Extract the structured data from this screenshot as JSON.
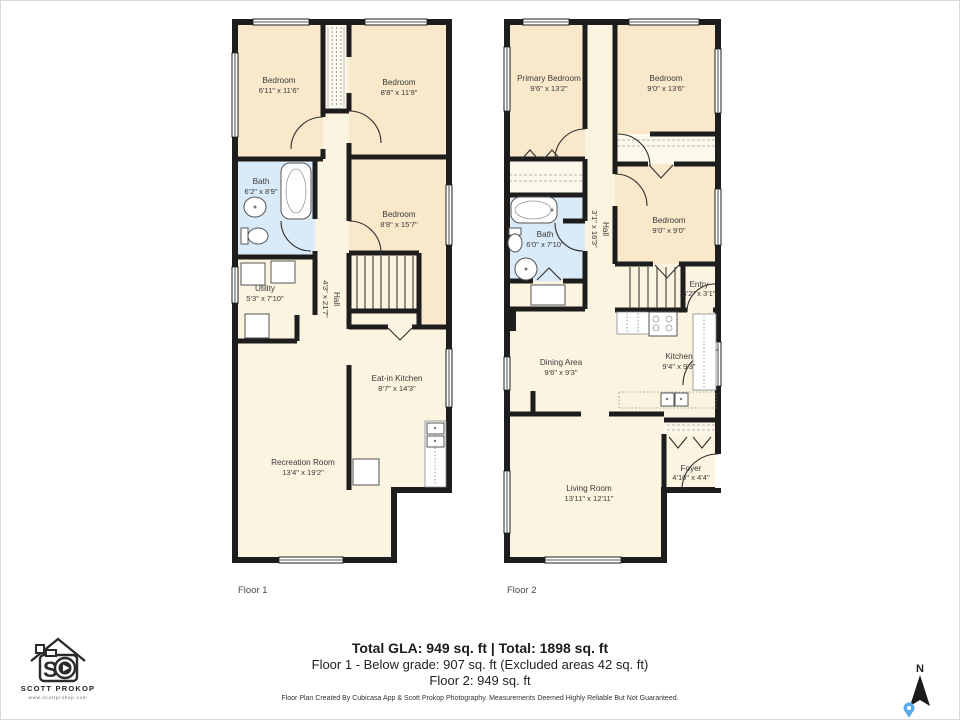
{
  "page": {
    "background": "#ffffff"
  },
  "colors": {
    "wall": "#1d1d1d",
    "bedroom_fill": "#f9e8ca",
    "common_fill": "#fbf4e0",
    "bath_fill": "#d9eaf8",
    "closet_fill": "#fcf8ec",
    "pin_accent": "#5aabe8"
  },
  "floors": [
    {
      "label": "Floor 1",
      "rooms": [
        {
          "name": "Bedroom",
          "dims": "6'11\" x 11'6\""
        },
        {
          "name": "Bedroom",
          "dims": "8'8\" x 11'9\""
        },
        {
          "name": "Bath",
          "dims": "6'2\" x 8'9\""
        },
        {
          "name": "Bedroom",
          "dims": "8'8\" x 15'7\""
        },
        {
          "name": "Utility",
          "dims": "5'3\" x 7'10\""
        },
        {
          "name": "Hall",
          "dims": "4'3\" x 21'7\""
        },
        {
          "name": "Eat-in Kitchen",
          "dims": "8'7\" x 14'3\""
        },
        {
          "name": "Recreation Room",
          "dims": "13'4\" x 19'2\""
        }
      ]
    },
    {
      "label": "Floor 2",
      "rooms": [
        {
          "name": "Primary Bedroom",
          "dims": "9'6\" x 13'2\""
        },
        {
          "name": "Bedroom",
          "dims": "9'0\" x 13'6\""
        },
        {
          "name": "Bedroom",
          "dims": "9'0\" x 9'0\""
        },
        {
          "name": "Bath",
          "dims": "6'0\" x 7'10\""
        },
        {
          "name": "Hall",
          "dims": "3'1\" x 16'3\""
        },
        {
          "name": "Entry",
          "dims": "3'2\" x 3'1\""
        },
        {
          "name": "Dining Area",
          "dims": "9'6\" x 9'3\""
        },
        {
          "name": "Kitchen",
          "dims": "9'4\" x 9'3\""
        },
        {
          "name": "Foyer",
          "dims": "4'10\" x 4'4\""
        },
        {
          "name": "Living Room",
          "dims": "13'11\" x 12'11\""
        }
      ]
    }
  ],
  "footer": {
    "total_line": "Total GLA: 949 sq. ft | Total: 1898 sq. ft",
    "floor1_line": "Floor 1 - Below grade: 907 sq. ft (Excluded areas 42 sq. ft)",
    "floor2_line": "Floor 2: 949 sq. ft",
    "disclaimer": "Floor Plan Created By Cubicasa App & Scott Prokop Photography. Measurements Deemed Highly Reliable But Not Guaranteed."
  },
  "brand": {
    "name": "SCOTT PROKOP",
    "website": "www.scottprokop.com",
    "monogram": "S"
  },
  "compass": {
    "label": "N"
  }
}
